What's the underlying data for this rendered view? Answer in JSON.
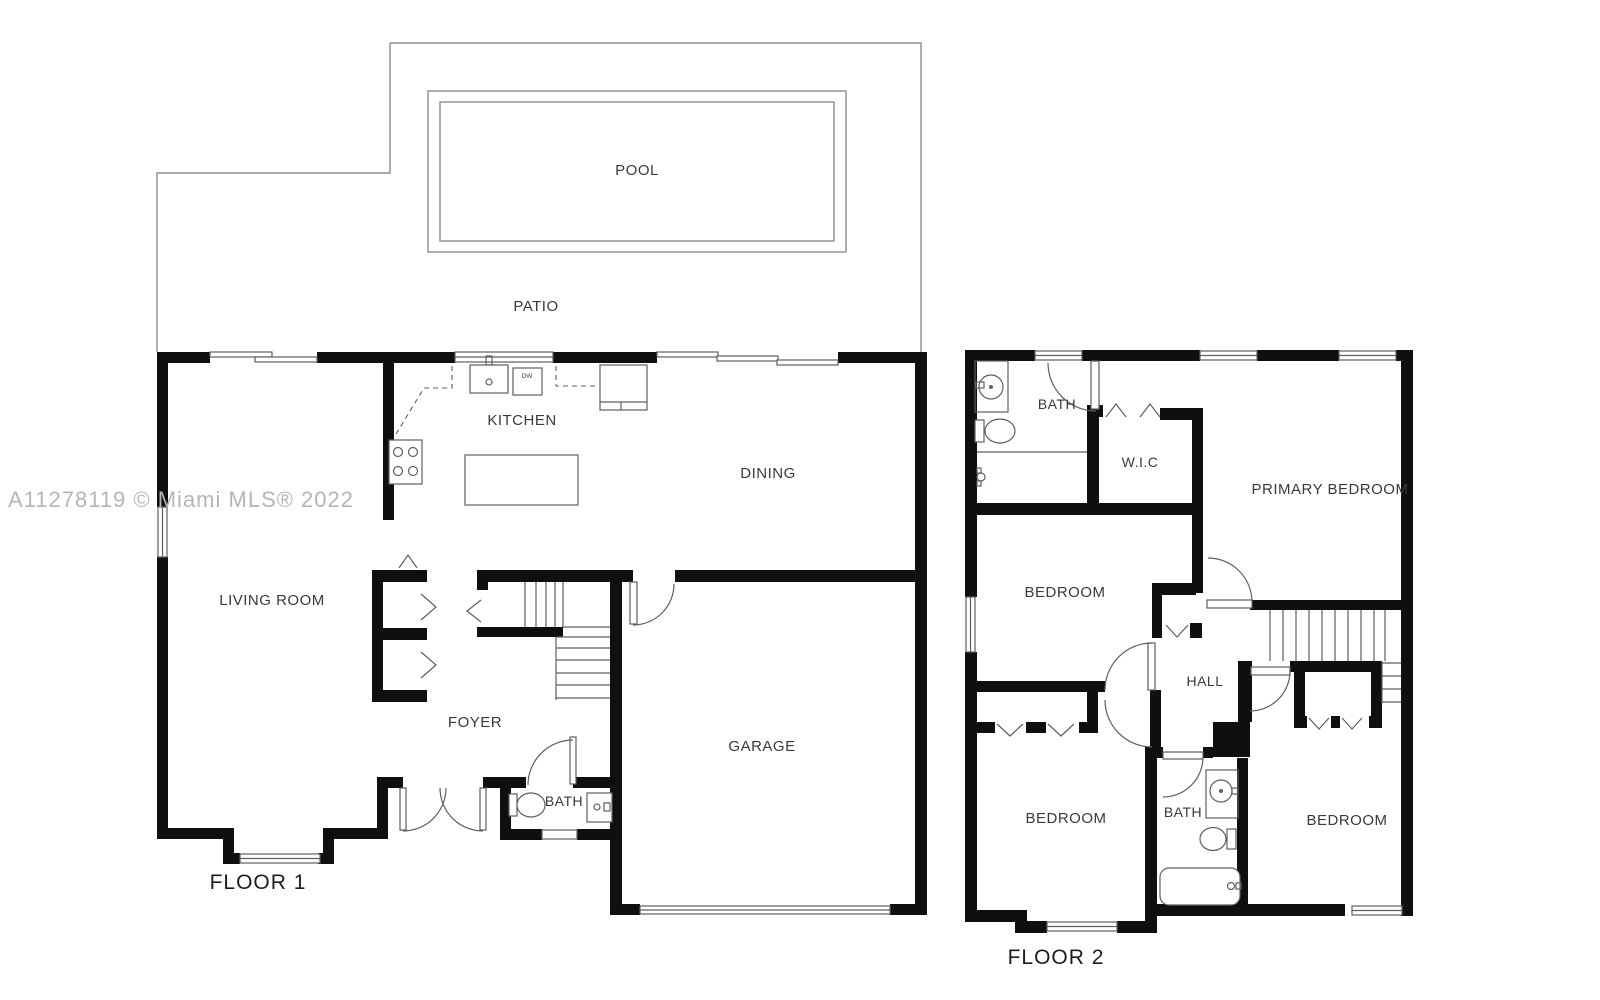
{
  "watermark": "A11278119 © Miami MLS® 2022",
  "floor1": {
    "title": "FLOOR 1",
    "rooms": {
      "pool": "POOL",
      "patio": "PATIO",
      "kitchen": "KITCHEN",
      "dining": "DINING",
      "living_room": "LIVING ROOM",
      "foyer": "FOYER",
      "bath": "BATH",
      "garage": "GARAGE"
    },
    "appliances": {
      "dishwasher": "DW"
    }
  },
  "floor2": {
    "title": "FLOOR 2",
    "rooms": {
      "bath_top": "BATH",
      "walk_in_closet": "W.I.C",
      "primary_bedroom": "PRIMARY BEDROOM",
      "bedroom_left": "BEDROOM",
      "hall": "HALL",
      "bedroom_bottom_left": "BEDROOM",
      "bath_bottom": "BATH",
      "bedroom_bottom_right": "BEDROOM"
    }
  },
  "colors": {
    "wall": "#0f0f0f",
    "thin": "#5f5f5f",
    "patio": "#8d8d8d",
    "label": "#3a3a3a",
    "title": "#1d1d1d",
    "watermark": "#b5b5b5"
  }
}
